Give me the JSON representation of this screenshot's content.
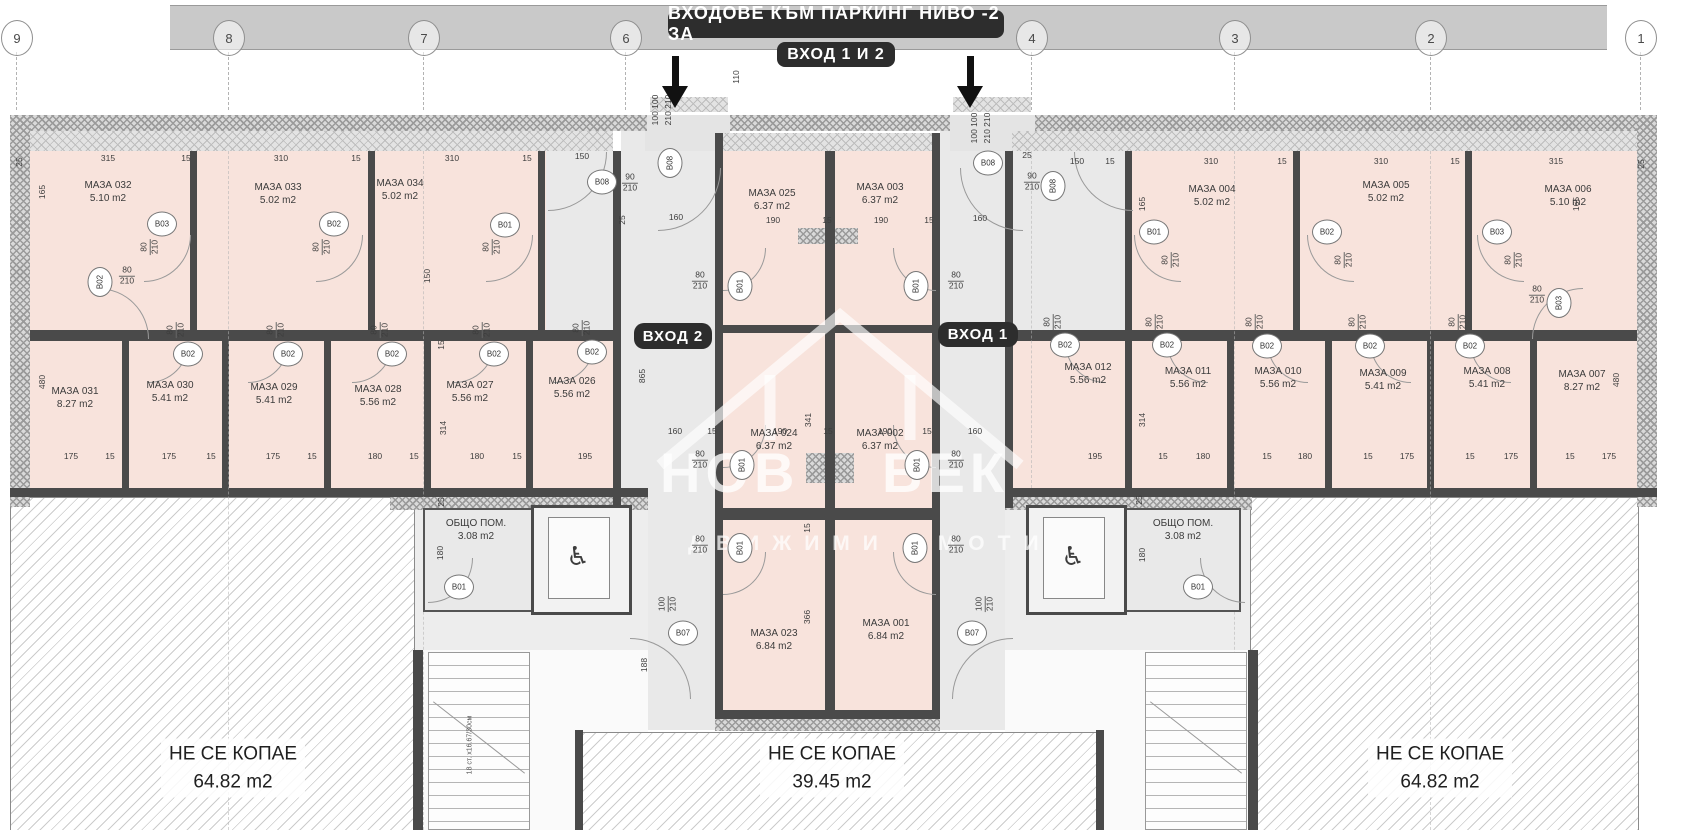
{
  "title": {
    "line1": "ВХОДОВЕ КЪМ ПАРКИНГ НИВО -2 ЗА",
    "line2": "ВХОД 1 И 2"
  },
  "entrances": [
    {
      "label": "ВХОД 2",
      "x": 634,
      "y": 323
    },
    {
      "label": "ВХОД 1",
      "x": 938,
      "y": 322
    }
  ],
  "grid_bubbles": [
    {
      "n": "9",
      "x": 16
    },
    {
      "n": "8",
      "x": 228
    },
    {
      "n": "7",
      "x": 423
    },
    {
      "n": "6",
      "x": 625
    },
    {
      "n": "4",
      "x": 1031
    },
    {
      "n": "3",
      "x": 1234
    },
    {
      "n": "2",
      "x": 1430
    },
    {
      "n": "1",
      "x": 1640
    }
  ],
  "rooms": [
    {
      "name": "МАЗА 032",
      "area": "5.10 m2",
      "x": 108,
      "y": 192
    },
    {
      "name": "МАЗА 033",
      "area": "5.02 m2",
      "x": 278,
      "y": 194
    },
    {
      "name": "МАЗА 034",
      "area": "5.02 m2",
      "x": 400,
      "y": 190
    },
    {
      "name": "МАЗА 031",
      "area": "8.27 m2",
      "x": 75,
      "y": 398
    },
    {
      "name": "МАЗА 030",
      "area": "5.41 m2",
      "x": 170,
      "y": 392
    },
    {
      "name": "МАЗА 029",
      "area": "5.41 m2",
      "x": 274,
      "y": 394
    },
    {
      "name": "МАЗА 028",
      "area": "5.56 m2",
      "x": 378,
      "y": 396
    },
    {
      "name": "МАЗА 027",
      "area": "5.56 m2",
      "x": 470,
      "y": 392
    },
    {
      "name": "МАЗА 026",
      "area": "5.56 m2",
      "x": 572,
      "y": 388
    },
    {
      "name": "МАЗА 025",
      "area": "6.37 m2",
      "x": 772,
      "y": 200
    },
    {
      "name": "МАЗА 003",
      "area": "6.37 m2",
      "x": 880,
      "y": 194
    },
    {
      "name": "МАЗА 024",
      "area": "6.37 m2",
      "x": 774,
      "y": 440
    },
    {
      "name": "МАЗА 002",
      "area": "6.37 m2",
      "x": 880,
      "y": 440
    },
    {
      "name": "МАЗА 023",
      "area": "6.84 m2",
      "x": 774,
      "y": 640
    },
    {
      "name": "МАЗА 001",
      "area": "6.84 m2",
      "x": 886,
      "y": 630
    },
    {
      "name": "МАЗА 004",
      "area": "5.02 m2",
      "x": 1212,
      "y": 196
    },
    {
      "name": "МАЗА 005",
      "area": "5.02 m2",
      "x": 1386,
      "y": 192
    },
    {
      "name": "МАЗА 006",
      "area": "5.10 m2",
      "x": 1568,
      "y": 196
    },
    {
      "name": "МАЗА 012",
      "area": "5.56 m2",
      "x": 1088,
      "y": 374
    },
    {
      "name": "МАЗА 011",
      "area": "5.56 m2",
      "x": 1188,
      "y": 378
    },
    {
      "name": "МАЗА 010",
      "area": "5.56 m2",
      "x": 1278,
      "y": 378
    },
    {
      "name": "МАЗА 009",
      "area": "5.41 m2",
      "x": 1383,
      "y": 380
    },
    {
      "name": "МАЗА 008",
      "area": "5.41 m2",
      "x": 1487,
      "y": 378
    },
    {
      "name": "МАЗА 007",
      "area": "8.27 m2",
      "x": 1582,
      "y": 381
    }
  ],
  "common_rooms": [
    {
      "name": "ОБЩО ПОМ.",
      "area": "3.08 m2",
      "x": 476,
      "y": 530
    },
    {
      "name": "ОБЩО ПОМ.",
      "area": "3.08 m2",
      "x": 1183,
      "y": 530
    }
  ],
  "no_dig": [
    {
      "l1": "НЕ СЕ КОПАЕ",
      "l2": "64.82 m2",
      "x": 233,
      "y": 768
    },
    {
      "l1": "НЕ СЕ КОПАЕ",
      "l2": "39.45 m2",
      "x": 832,
      "y": 768
    },
    {
      "l1": "НЕ СЕ КОПАЕ",
      "l2": "64.82 m2",
      "x": 1440,
      "y": 768
    }
  ],
  "door_tags": [
    {
      "t": "B02",
      "x": 100,
      "y": 282,
      "r": 1
    },
    {
      "t": "B03",
      "x": 162,
      "y": 224
    },
    {
      "t": "B02",
      "x": 334,
      "y": 224
    },
    {
      "t": "B01",
      "x": 505,
      "y": 225
    },
    {
      "t": "B08",
      "x": 602,
      "y": 182
    },
    {
      "t": "B08",
      "x": 670,
      "y": 163,
      "r": 1
    },
    {
      "t": "B02",
      "x": 188,
      "y": 354
    },
    {
      "t": "B02",
      "x": 288,
      "y": 354
    },
    {
      "t": "B02",
      "x": 392,
      "y": 354
    },
    {
      "t": "B02",
      "x": 494,
      "y": 354
    },
    {
      "t": "B02",
      "x": 592,
      "y": 352
    },
    {
      "t": "B01",
      "x": 740,
      "y": 286,
      "r": 1
    },
    {
      "t": "B01",
      "x": 916,
      "y": 286,
      "r": 1
    },
    {
      "t": "B01",
      "x": 742,
      "y": 465,
      "r": 1
    },
    {
      "t": "B01",
      "x": 917,
      "y": 465,
      "r": 1
    },
    {
      "t": "B01",
      "x": 740,
      "y": 548,
      "r": 1
    },
    {
      "t": "B01",
      "x": 915,
      "y": 548,
      "r": 1
    },
    {
      "t": "B07",
      "x": 683,
      "y": 633
    },
    {
      "t": "B07",
      "x": 972,
      "y": 633
    },
    {
      "t": "B01",
      "x": 459,
      "y": 587
    },
    {
      "t": "B01",
      "x": 1198,
      "y": 587
    },
    {
      "t": "B08",
      "x": 988,
      "y": 163
    },
    {
      "t": "B08",
      "x": 1053,
      "y": 186,
      "r": 1
    },
    {
      "t": "B01",
      "x": 1154,
      "y": 232
    },
    {
      "t": "B02",
      "x": 1327,
      "y": 232
    },
    {
      "t": "B03",
      "x": 1497,
      "y": 232
    },
    {
      "t": "B03",
      "x": 1559,
      "y": 303,
      "r": 1
    },
    {
      "t": "B02",
      "x": 1065,
      "y": 345
    },
    {
      "t": "B02",
      "x": 1167,
      "y": 345
    },
    {
      "t": "B02",
      "x": 1267,
      "y": 346
    },
    {
      "t": "B02",
      "x": 1370,
      "y": 346
    },
    {
      "t": "B02",
      "x": 1470,
      "y": 346
    }
  ],
  "dims": [
    {
      "t": "25",
      "x": 20,
      "y": 162,
      "r": 1
    },
    {
      "t": "315",
      "x": 108,
      "y": 159
    },
    {
      "t": "15",
      "x": 186,
      "y": 159
    },
    {
      "t": "310",
      "x": 281,
      "y": 159
    },
    {
      "t": "15",
      "x": 356,
      "y": 159
    },
    {
      "t": "310",
      "x": 452,
      "y": 159
    },
    {
      "t": "15",
      "x": 527,
      "y": 159
    },
    {
      "t": "150",
      "x": 582,
      "y": 157
    },
    {
      "t": "90",
      "t2": "210",
      "x": 630,
      "y": 183
    },
    {
      "t": "160",
      "x": 676,
      "y": 218
    },
    {
      "t": "25",
      "x": 623,
      "y": 220,
      "r": 1
    },
    {
      "t": "110",
      "x": 737,
      "y": 77,
      "r": 1
    },
    {
      "t": "100 100",
      "x": 656,
      "y": 110,
      "r": 1
    },
    {
      "t": "210 210",
      "x": 669,
      "y": 110,
      "r": 1
    },
    {
      "t": "190",
      "x": 773,
      "y": 221
    },
    {
      "t": "15",
      "x": 827,
      "y": 221
    },
    {
      "t": "190",
      "x": 881,
      "y": 221
    },
    {
      "t": "15",
      "x": 929,
      "y": 221
    },
    {
      "t": "160",
      "x": 980,
      "y": 219
    },
    {
      "t": "100 100",
      "x": 975,
      "y": 128,
      "r": 1
    },
    {
      "t": "210 210",
      "x": 988,
      "y": 128,
      "r": 1
    },
    {
      "t": "90",
      "t2": "210",
      "x": 1032,
      "y": 182
    },
    {
      "t": "25",
      "x": 1027,
      "y": 156
    },
    {
      "t": "150",
      "x": 1077,
      "y": 162
    },
    {
      "t": "15",
      "x": 1110,
      "y": 162
    },
    {
      "t": "310",
      "x": 1211,
      "y": 162
    },
    {
      "t": "15",
      "x": 1282,
      "y": 162
    },
    {
      "t": "310",
      "x": 1381,
      "y": 162
    },
    {
      "t": "15",
      "x": 1455,
      "y": 162
    },
    {
      "t": "315",
      "x": 1556,
      "y": 162
    },
    {
      "t": "25",
      "x": 1642,
      "y": 164,
      "r": 1
    },
    {
      "t": "165",
      "x": 43,
      "y": 192,
      "r": 1
    },
    {
      "t": "165",
      "x": 1143,
      "y": 204,
      "r": 1
    },
    {
      "t": "165",
      "x": 1577,
      "y": 204,
      "r": 1
    },
    {
      "t": "150",
      "x": 428,
      "y": 276,
      "r": 1
    },
    {
      "t": "480",
      "x": 43,
      "y": 382,
      "r": 1
    },
    {
      "t": "480",
      "x": 1617,
      "y": 380,
      "r": 1
    },
    {
      "t": "314",
      "x": 444,
      "y": 428,
      "r": 1
    },
    {
      "t": "314",
      "x": 1143,
      "y": 420,
      "r": 1
    },
    {
      "t": "15",
      "x": 442,
      "y": 345,
      "r": 1
    },
    {
      "t": "865",
      "x": 643,
      "y": 376,
      "r": 1
    },
    {
      "t": "341",
      "x": 809,
      "y": 420,
      "r": 1
    },
    {
      "t": "366",
      "x": 808,
      "y": 617,
      "r": 1
    },
    {
      "t": "188",
      "x": 645,
      "y": 665,
      "r": 1
    },
    {
      "t": "15",
      "x": 808,
      "y": 528,
      "r": 1
    },
    {
      "t": "160",
      "x": 675,
      "y": 432
    },
    {
      "t": "15",
      "x": 712,
      "y": 432
    },
    {
      "t": "190",
      "x": 780,
      "y": 432
    },
    {
      "t": "15",
      "x": 828,
      "y": 432
    },
    {
      "t": "190",
      "x": 885,
      "y": 432
    },
    {
      "t": "15",
      "x": 927,
      "y": 432
    },
    {
      "t": "160",
      "x": 975,
      "y": 432
    },
    {
      "t": "175",
      "x": 71,
      "y": 457
    },
    {
      "t": "15",
      "x": 110,
      "y": 457
    },
    {
      "t": "175",
      "x": 169,
      "y": 457
    },
    {
      "t": "15",
      "x": 211,
      "y": 457
    },
    {
      "t": "175",
      "x": 273,
      "y": 457
    },
    {
      "t": "15",
      "x": 312,
      "y": 457
    },
    {
      "t": "180",
      "x": 375,
      "y": 457
    },
    {
      "t": "15",
      "x": 414,
      "y": 457
    },
    {
      "t": "180",
      "x": 477,
      "y": 457
    },
    {
      "t": "15",
      "x": 517,
      "y": 457
    },
    {
      "t": "195",
      "x": 585,
      "y": 457
    },
    {
      "t": "195",
      "x": 1095,
      "y": 457
    },
    {
      "t": "15",
      "x": 1163,
      "y": 457
    },
    {
      "t": "180",
      "x": 1203,
      "y": 457
    },
    {
      "t": "15",
      "x": 1267,
      "y": 457
    },
    {
      "t": "180",
      "x": 1305,
      "y": 457
    },
    {
      "t": "15",
      "x": 1368,
      "y": 457
    },
    {
      "t": "175",
      "x": 1407,
      "y": 457
    },
    {
      "t": "15",
      "x": 1470,
      "y": 457
    },
    {
      "t": "175",
      "x": 1511,
      "y": 457
    },
    {
      "t": "15",
      "x": 1570,
      "y": 457
    },
    {
      "t": "175",
      "x": 1609,
      "y": 457
    },
    {
      "t": "25",
      "x": 442,
      "y": 502,
      "r": 1
    },
    {
      "t": "180",
      "x": 441,
      "y": 553,
      "r": 1
    },
    {
      "t": "25",
      "x": 1140,
      "y": 500,
      "r": 1
    },
    {
      "t": "180",
      "x": 1143,
      "y": 555,
      "r": 1
    },
    {
      "t": "100",
      "t2": "210",
      "x": 668,
      "y": 604,
      "r": 1
    },
    {
      "t": "100",
      "t2": "210",
      "x": 985,
      "y": 604,
      "r": 1
    },
    {
      "t": "80",
      "t2": "210",
      "x": 150,
      "y": 247,
      "r": 1
    },
    {
      "t": "80",
      "t2": "210",
      "x": 322,
      "y": 247,
      "r": 1
    },
    {
      "t": "80",
      "t2": "210",
      "x": 492,
      "y": 247,
      "r": 1
    },
    {
      "t": "80",
      "t2": "210",
      "x": 127,
      "y": 276
    },
    {
      "t": "80",
      "t2": "210",
      "x": 176,
      "y": 330,
      "r": 1
    },
    {
      "t": "80",
      "t2": "210",
      "x": 276,
      "y": 330,
      "r": 1
    },
    {
      "t": "80",
      "t2": "210",
      "x": 380,
      "y": 330,
      "r": 1
    },
    {
      "t": "80",
      "t2": "210",
      "x": 482,
      "y": 330,
      "r": 1
    },
    {
      "t": "80",
      "t2": "210",
      "x": 582,
      "y": 328,
      "r": 1
    },
    {
      "t": "80",
      "t2": "210",
      "x": 1053,
      "y": 322,
      "r": 1
    },
    {
      "t": "80",
      "t2": "210",
      "x": 1155,
      "y": 322,
      "r": 1
    },
    {
      "t": "80",
      "t2": "210",
      "x": 1255,
      "y": 322,
      "r": 1
    },
    {
      "t": "80",
      "t2": "210",
      "x": 1358,
      "y": 322,
      "r": 1
    },
    {
      "t": "80",
      "t2": "210",
      "x": 1458,
      "y": 322,
      "r": 1
    },
    {
      "t": "80",
      "t2": "210",
      "x": 1171,
      "y": 260,
      "r": 1
    },
    {
      "t": "80",
      "t2": "210",
      "x": 1344,
      "y": 260,
      "r": 1
    },
    {
      "t": "80",
      "t2": "210",
      "x": 1514,
      "y": 260,
      "r": 1
    },
    {
      "t": "80",
      "t2": "210",
      "x": 1537,
      "y": 295
    },
    {
      "t": "80",
      "t2": "210",
      "x": 700,
      "y": 281
    },
    {
      "t": "80",
      "t2": "210",
      "x": 956,
      "y": 281
    },
    {
      "t": "80",
      "t2": "210",
      "x": 700,
      "y": 460
    },
    {
      "t": "80",
      "t2": "210",
      "x": 956,
      "y": 460
    },
    {
      "t": "80",
      "t2": "210",
      "x": 700,
      "y": 545
    },
    {
      "t": "80",
      "t2": "210",
      "x": 956,
      "y": 545
    }
  ],
  "arcs": [
    {
      "x": 144,
      "y": 235,
      "s": 46,
      "o": "br"
    },
    {
      "x": 316,
      "y": 235,
      "s": 46,
      "o": "br"
    },
    {
      "x": 486,
      "y": 235,
      "s": 46,
      "o": "br"
    },
    {
      "x": 98,
      "y": 288,
      "s": 50,
      "o": "tr"
    },
    {
      "x": 148,
      "y": 342,
      "s": 40,
      "o": "br"
    },
    {
      "x": 248,
      "y": 342,
      "s": 40,
      "o": "br"
    },
    {
      "x": 352,
      "y": 342,
      "s": 40,
      "o": "br"
    },
    {
      "x": 454,
      "y": 342,
      "s": 40,
      "o": "br"
    },
    {
      "x": 554,
      "y": 342,
      "s": 40,
      "o": "br"
    },
    {
      "x": 1065,
      "y": 342,
      "s": 40,
      "o": "bl"
    },
    {
      "x": 1167,
      "y": 342,
      "s": 40,
      "o": "bl"
    },
    {
      "x": 1267,
      "y": 342,
      "s": 40,
      "o": "bl"
    },
    {
      "x": 1370,
      "y": 342,
      "s": 40,
      "o": "bl"
    },
    {
      "x": 1470,
      "y": 342,
      "s": 40,
      "o": "bl"
    },
    {
      "x": 1134,
      "y": 235,
      "s": 46,
      "o": "bl"
    },
    {
      "x": 1307,
      "y": 235,
      "s": 46,
      "o": "bl"
    },
    {
      "x": 1477,
      "y": 235,
      "s": 46,
      "o": "bl"
    },
    {
      "x": 1532,
      "y": 288,
      "s": 50,
      "o": "tl"
    },
    {
      "x": 548,
      "y": 152,
      "s": 58,
      "o": "br"
    },
    {
      "x": 658,
      "y": 168,
      "s": 62,
      "o": "br"
    },
    {
      "x": 1074,
      "y": 152,
      "s": 58,
      "o": "bl"
    },
    {
      "x": 960,
      "y": 168,
      "s": 62,
      "o": "bl"
    },
    {
      "x": 723,
      "y": 248,
      "s": 42,
      "o": "br"
    },
    {
      "x": 893,
      "y": 248,
      "s": 42,
      "o": "bl"
    },
    {
      "x": 723,
      "y": 425,
      "s": 42,
      "o": "br"
    },
    {
      "x": 893,
      "y": 425,
      "s": 42,
      "o": "bl"
    },
    {
      "x": 723,
      "y": 552,
      "s": 42,
      "o": "br"
    },
    {
      "x": 893,
      "y": 552,
      "s": 42,
      "o": "bl"
    },
    {
      "x": 630,
      "y": 638,
      "s": 60,
      "o": "tr"
    },
    {
      "x": 952,
      "y": 638,
      "s": 60,
      "o": "tl"
    },
    {
      "x": 428,
      "y": 558,
      "s": 44,
      "o": "br"
    },
    {
      "x": 1200,
      "y": 558,
      "s": 44,
      "o": "bl"
    }
  ],
  "stairs_note": "18 ст. х16.67/30см",
  "watermark": {
    "w1": "НОВ",
    "w2": "ВЕК",
    "sub": "ДВИЖИМИ ИМОТИ"
  },
  "wheelchair_icon": "♿",
  "colors": {
    "room_fill": "#f8e3dc",
    "corridor_fill": "#e9e9e9",
    "wall": "#4a4a4a",
    "top_band": "#c9c9c9",
    "label_bg": "#2d2d2d"
  }
}
